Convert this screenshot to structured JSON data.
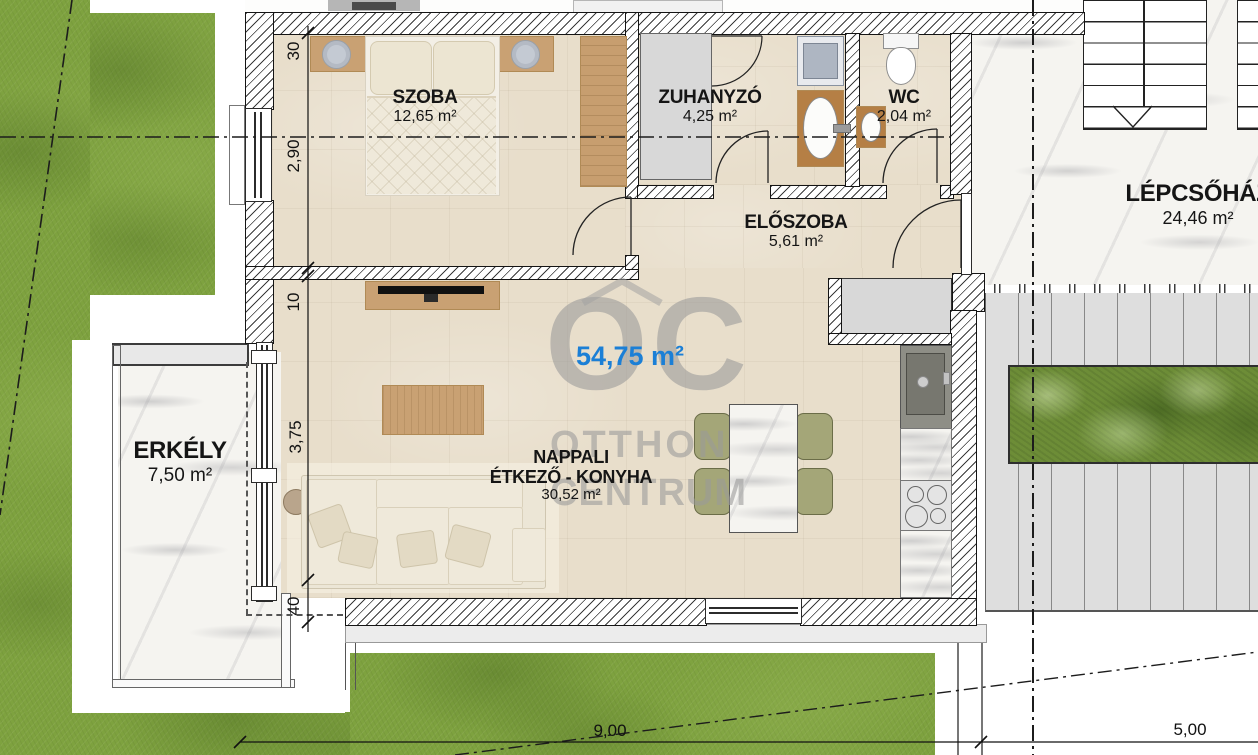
{
  "watermark": {
    "logo": "OC",
    "brand_line1": "OTTHON",
    "brand_line2": "CENTRUM"
  },
  "total_area": "54,75 m²",
  "rooms": {
    "szoba": {
      "name": "SZOBA",
      "area": "12,65 m²"
    },
    "zuhanyzo": {
      "name": "ZUHANYZÓ",
      "area": "4,25 m²"
    },
    "wc": {
      "name": "WC",
      "area": "2,04 m²"
    },
    "eloszoba": {
      "name": "ELŐSZOBA",
      "area": "5,61 m²"
    },
    "nappali": {
      "name_line1": "NAPPALI",
      "name_line2": "ÉTKEZŐ - KONYHA",
      "area": "30,52 m²"
    },
    "erkely": {
      "name": "ERKÉLY",
      "area": "7,50 m²"
    },
    "lepcsohaz": {
      "name": "LÉPCSŐHÁZ",
      "area": "24,46 m²"
    }
  },
  "dimensions": {
    "left_chain": [
      "30",
      "2,90",
      "10",
      "3,75",
      "40"
    ],
    "bottom": [
      "9,00",
      "5,00"
    ]
  },
  "colors": {
    "total_area_text": "#1b7fd6",
    "grass": "#7ea23f",
    "floor": "#e8decb",
    "marble": "#f5f4f0",
    "deck": "#dedede",
    "hedge": "#6d8d37",
    "watermark": "#9a9a9a"
  }
}
